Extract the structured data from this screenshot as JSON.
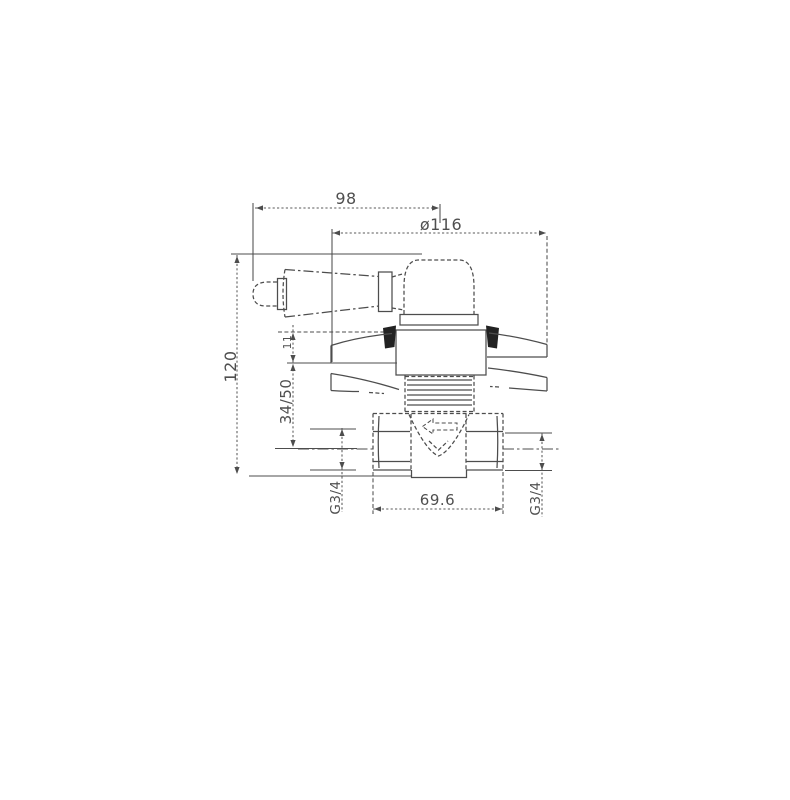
{
  "canvas": {
    "width": 790,
    "height": 800,
    "background": "#ffffff"
  },
  "drawing": {
    "ink_color": "#4d4d4d",
    "dim_color": "#5a5a5a",
    "labels": {
      "handle_length": "98",
      "plate_diameter": "ø116",
      "overall_height": "120",
      "plate_offset": "11",
      "mounting_depth": "34/50",
      "body_width": "69.6",
      "thread_left": "G3/4",
      "thread_right": "G3/4"
    }
  }
}
